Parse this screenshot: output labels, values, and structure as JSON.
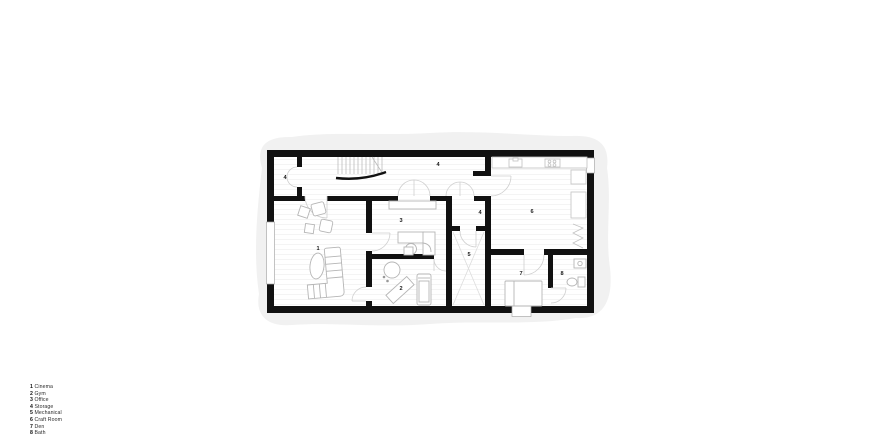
{
  "page": {
    "background": "#ffffff",
    "description": "Basement floor plan drawing with numbered rooms and legend"
  },
  "plan": {
    "colors": {
      "wall": "#111111",
      "furniture_outline": "#b5b5b5",
      "door_arc": "#cfcfcf",
      "shadow_blob": "#f1f1f1",
      "label_text": "#1a1a1a",
      "floor_line": "#f2f2f2"
    },
    "room_labels": [
      {
        "room": "cinema",
        "text": "1"
      },
      {
        "room": "gym",
        "text": "2"
      },
      {
        "room": "office",
        "text": "3"
      },
      {
        "room": "storage-top-left",
        "text": "4"
      },
      {
        "room": "storage-corridor",
        "text": "4"
      },
      {
        "room": "storage-middle",
        "text": "4"
      },
      {
        "room": "mechanical",
        "text": "5"
      },
      {
        "room": "craft-room",
        "text": "6"
      },
      {
        "room": "den",
        "text": "7"
      },
      {
        "room": "bath",
        "text": "8"
      }
    ]
  },
  "legend": {
    "items": [
      {
        "num": "1",
        "name": "Cinema"
      },
      {
        "num": "2",
        "name": "Gym"
      },
      {
        "num": "3",
        "name": "Office"
      },
      {
        "num": "4",
        "name": "Storage"
      },
      {
        "num": "5",
        "name": "Mechanical"
      },
      {
        "num": "6",
        "name": "Craft Room"
      },
      {
        "num": "7",
        "name": "Den"
      },
      {
        "num": "8",
        "name": "Bath"
      }
    ]
  }
}
